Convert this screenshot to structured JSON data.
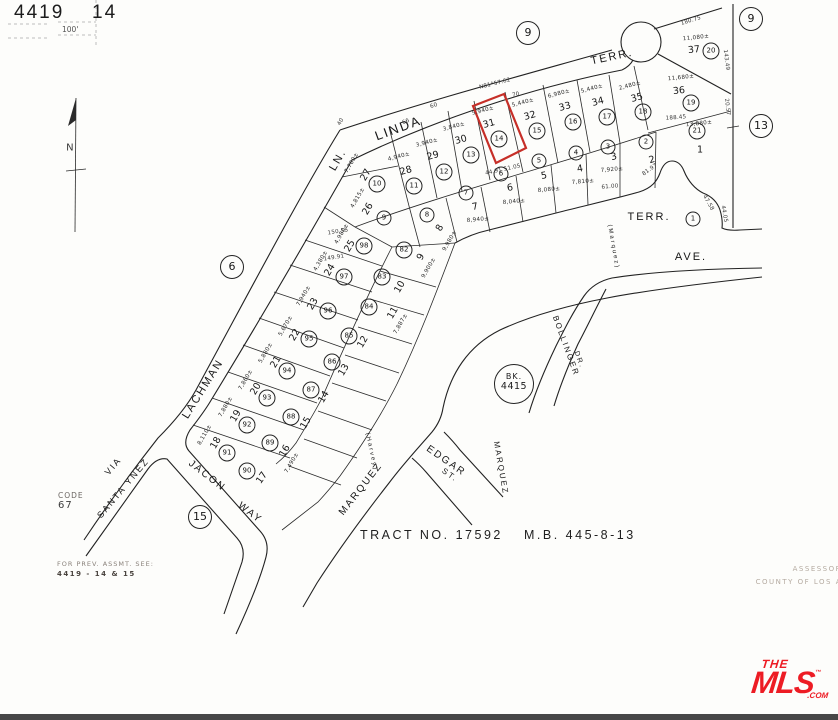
{
  "page": {
    "book": "4419",
    "sheet": "14",
    "scale": "100'"
  },
  "annotations": {
    "tract": "TRACT NO. 17592",
    "map_book": "M.B. 445-8-13",
    "code_label": "CODE",
    "code_value": "67",
    "prev_note_1": "FOR PREV. ASSMT. SEE:",
    "prev_note_2": "4419 - 14 & 15",
    "assessor_1": "ASSESSOR",
    "assessor_2": "COUNTY OF LOS A",
    "north_letter": "N"
  },
  "bk_badge": {
    "line1": "BK.",
    "line2": "4415"
  },
  "logo": {
    "the": "THE",
    "mls": "MLS",
    "tm": "™",
    "com": ".COM",
    "color": "#ed1c24"
  },
  "highlight": {
    "lot": "31",
    "color": "#c62f28"
  },
  "page_refs": [
    {
      "t": "9",
      "x": 528,
      "y": 33
    },
    {
      "t": "9",
      "x": 751,
      "y": 19
    },
    {
      "t": "13",
      "x": 761,
      "y": 126
    },
    {
      "t": "6",
      "x": 232,
      "y": 267
    },
    {
      "t": "15",
      "x": 200,
      "y": 517
    }
  ],
  "streets": [
    {
      "t": "LINDA",
      "x": 398,
      "y": 128,
      "r": -20,
      "s": 13
    },
    {
      "t": "LN.",
      "x": 338,
      "y": 160,
      "r": -60,
      "s": 11
    },
    {
      "t": "TERR.",
      "x": 612,
      "y": 57,
      "r": -12,
      "s": 11
    },
    {
      "t": "LACHMAN",
      "x": 203,
      "y": 389,
      "r": -58,
      "s": 11
    },
    {
      "t": "TERR.",
      "x": 649,
      "y": 217,
      "r": 0,
      "s": 11
    },
    {
      "t": "AVE.",
      "x": 691,
      "y": 257,
      "r": 0,
      "s": 11
    },
    {
      "t": "(Marquez)",
      "x": 613,
      "y": 247,
      "r": 80,
      "s": 6
    },
    {
      "t": "BOLLINGER",
      "x": 566,
      "y": 346,
      "r": 70,
      "s": 8
    },
    {
      "t": "DR.",
      "x": 579,
      "y": 360,
      "r": 70,
      "s": 7
    },
    {
      "t": "EDGAR",
      "x": 446,
      "y": 461,
      "r": 35,
      "s": 10
    },
    {
      "t": "ST.",
      "x": 450,
      "y": 475,
      "r": 35,
      "s": 8
    },
    {
      "t": "MARQUEZ",
      "x": 361,
      "y": 489,
      "r": -52,
      "s": 10
    },
    {
      "t": "MARQUEZ",
      "x": 501,
      "y": 468,
      "r": 80,
      "s": 8
    },
    {
      "t": "(Harvey)",
      "x": 371,
      "y": 452,
      "r": 78,
      "s": 6
    },
    {
      "t": "JACON",
      "x": 207,
      "y": 476,
      "r": 38,
      "s": 10
    },
    {
      "t": "WAY",
      "x": 250,
      "y": 513,
      "r": 38,
      "s": 10
    },
    {
      "t": "VIA",
      "x": 113,
      "y": 466,
      "r": -50,
      "s": 9
    },
    {
      "t": "SANTA YNEZ",
      "x": 123,
      "y": 488,
      "r": -50,
      "s": 9
    }
  ],
  "dims": [
    {
      "t": "N81°57.62",
      "x": 495,
      "y": 84,
      "r": -14
    },
    {
      "t": "70",
      "x": 516,
      "y": 95,
      "r": -14
    },
    {
      "t": "66",
      "x": 406,
      "y": 122,
      "r": -22
    },
    {
      "t": "60",
      "x": 434,
      "y": 106,
      "r": -20
    },
    {
      "t": "40",
      "x": 341,
      "y": 122,
      "r": -60
    },
    {
      "t": "44.91  51.05",
      "x": 503,
      "y": 170,
      "r": -12
    },
    {
      "t": "180.75",
      "x": 691,
      "y": 21,
      "r": -17
    },
    {
      "t": "143.49",
      "x": 726,
      "y": 60,
      "r": 83
    },
    {
      "t": "20.57",
      "x": 727,
      "y": 107,
      "r": 83
    },
    {
      "t": "188.45",
      "x": 676,
      "y": 118,
      "r": -4
    },
    {
      "t": "81.97",
      "x": 650,
      "y": 170,
      "r": -35
    },
    {
      "t": "61.00",
      "x": 610,
      "y": 187,
      "r": -5
    },
    {
      "t": "150.55",
      "x": 338,
      "y": 232,
      "r": -9
    },
    {
      "t": "149.91",
      "x": 334,
      "y": 258,
      "r": -9
    },
    {
      "t": "47.58",
      "x": 708,
      "y": 203,
      "r": 60
    },
    {
      "t": "44.05",
      "x": 724,
      "y": 214,
      "r": 80
    },
    {
      "t": "N",
      "x": 70,
      "y": 148,
      "r": 0,
      "s": 10
    }
  ],
  "lots": [
    {
      "n": "1",
      "x": 700,
      "y": 150,
      "r": 0,
      "c": "21",
      "cx": 697,
      "cy": 131,
      "a": "13,880±",
      "ax": 699,
      "ay": 124,
      "ar": -6
    },
    {
      "n": "2",
      "x": 652,
      "y": 160,
      "r": -15,
      "c": "2",
      "cx": 646,
      "cy": 142
    },
    {
      "n": "3",
      "x": 614,
      "y": 157,
      "r": -12,
      "c": "3",
      "cx": 608,
      "cy": 147,
      "a": "7,920±",
      "ax": 612,
      "ay": 170,
      "ar": -5
    },
    {
      "n": "4",
      "x": 580,
      "y": 169,
      "r": -10,
      "c": "4",
      "cx": 576,
      "cy": 153,
      "a": "7,810±",
      "ax": 583,
      "ay": 182,
      "ar": -5
    },
    {
      "n": "5",
      "x": 544,
      "y": 176,
      "r": -10,
      "c": "5",
      "cx": 539,
      "cy": 161,
      "a": "8,080±",
      "ax": 549,
      "ay": 190,
      "ar": -5
    },
    {
      "n": "6",
      "x": 510,
      "y": 188,
      "r": -10,
      "c": "6",
      "cx": 501,
      "cy": 174,
      "a": "8,040±",
      "ax": 514,
      "ay": 202,
      "ar": -5
    },
    {
      "n": "7",
      "x": 475,
      "y": 207,
      "r": -10,
      "c": "7",
      "cx": 466,
      "cy": 193,
      "a": "8,940±",
      "ax": 478,
      "ay": 220,
      "ar": -5
    },
    {
      "n": "8",
      "x": 440,
      "y": 228,
      "r": -60,
      "c": "8",
      "cx": 427,
      "cy": 215,
      "a": "9,980±",
      "ax": 450,
      "ay": 241,
      "ar": -60
    },
    {
      "n": "9",
      "x": 421,
      "y": 257,
      "r": -60,
      "c": "82",
      "cx": 404,
      "cy": 250,
      "a": "9,900±",
      "ax": 429,
      "ay": 268,
      "ar": -60
    },
    {
      "n": "10",
      "x": 400,
      "y": 287,
      "r": -60,
      "c": "83",
      "cx": 382,
      "cy": 277
    },
    {
      "n": "11",
      "x": 393,
      "y": 313,
      "r": -60,
      "c": "84",
      "cx": 369,
      "cy": 307,
      "a": "7,887±",
      "ax": 401,
      "ay": 324,
      "ar": -60
    },
    {
      "n": "12",
      "x": 363,
      "y": 342,
      "r": -60,
      "c": "85",
      "cx": 349,
      "cy": 336
    },
    {
      "n": "13",
      "x": 344,
      "y": 370,
      "r": -60,
      "c": "86",
      "cx": 332,
      "cy": 362
    },
    {
      "n": "14",
      "x": 324,
      "y": 397,
      "r": -60,
      "c": "87",
      "cx": 311,
      "cy": 390
    },
    {
      "n": "15",
      "x": 306,
      "y": 423,
      "r": -60,
      "c": "88",
      "cx": 291,
      "cy": 417
    },
    {
      "n": "16",
      "x": 285,
      "y": 451,
      "r": -60,
      "c": "89",
      "cx": 270,
      "cy": 443,
      "a": "7,490±",
      "ax": 292,
      "ay": 463,
      "ar": -60
    },
    {
      "n": "17",
      "x": 262,
      "y": 478,
      "r": -55,
      "c": "90",
      "cx": 247,
      "cy": 471
    },
    {
      "n": "18",
      "x": 216,
      "y": 443,
      "r": -60,
      "c": "91",
      "cx": 227,
      "cy": 453,
      "a": "8,110±",
      "ax": 205,
      "ay": 435,
      "ar": -60
    },
    {
      "n": "19",
      "x": 236,
      "y": 416,
      "r": -60,
      "c": "92",
      "cx": 247,
      "cy": 425,
      "a": "7,880±",
      "ax": 226,
      "ay": 407,
      "ar": -60
    },
    {
      "n": "20",
      "x": 256,
      "y": 389,
      "r": -60,
      "c": "93",
      "cx": 267,
      "cy": 398,
      "a": "7,860±",
      "ax": 246,
      "ay": 380,
      "ar": -60
    },
    {
      "n": "21",
      "x": 276,
      "y": 362,
      "r": -60,
      "c": "94",
      "cx": 287,
      "cy": 371,
      "a": "5,880±",
      "ax": 266,
      "ay": 353,
      "ar": -60
    },
    {
      "n": "22",
      "x": 295,
      "y": 335,
      "r": -60,
      "c": "95",
      "cx": 309,
      "cy": 339,
      "a": "5,670±",
      "ax": 286,
      "ay": 326,
      "ar": -60
    },
    {
      "n": "23",
      "x": 313,
      "y": 304,
      "r": -60,
      "c": "96",
      "cx": 328,
      "cy": 311,
      "a": "7,940±",
      "ax": 304,
      "ay": 296,
      "ar": -60
    },
    {
      "n": "24",
      "x": 330,
      "y": 270,
      "r": -60,
      "c": "97",
      "cx": 344,
      "cy": 277,
      "a": "4,380±",
      "ax": 321,
      "ay": 261,
      "ar": -60
    },
    {
      "n": "25",
      "x": 350,
      "y": 246,
      "r": -60,
      "c": "98",
      "cx": 364,
      "cy": 246,
      "a": "4,980±",
      "ax": 342,
      "ay": 234,
      "ar": -60
    },
    {
      "n": "26",
      "x": 368,
      "y": 209,
      "r": -60,
      "c": "9",
      "cx": 384,
      "cy": 218,
      "a": "4,815±",
      "ax": 358,
      "ay": 198,
      "ar": -60
    },
    {
      "n": "27",
      "x": 366,
      "y": 175,
      "r": -60,
      "c": "10",
      "cx": 377,
      "cy": 184,
      "a": "7,780±",
      "ax": 352,
      "ay": 163,
      "ar": -60
    },
    {
      "n": "28",
      "x": 406,
      "y": 171,
      "r": -15,
      "c": "11",
      "cx": 414,
      "cy": 186,
      "a": "4,940±",
      "ax": 399,
      "ay": 157,
      "ar": -15
    },
    {
      "n": "29",
      "x": 433,
      "y": 156,
      "r": -15,
      "c": "12",
      "cx": 444,
      "cy": 172,
      "a": "3,940±",
      "ax": 427,
      "ay": 143,
      "ar": -15
    },
    {
      "n": "30",
      "x": 461,
      "y": 140,
      "r": -15,
      "c": "13",
      "cx": 471,
      "cy": 155,
      "a": "3,840±",
      "ax": 454,
      "ay": 127,
      "ar": -15
    },
    {
      "n": "31",
      "x": 489,
      "y": 124,
      "r": -15,
      "c": "14",
      "cx": 499,
      "cy": 139,
      "a": "5,940±",
      "ax": 483,
      "ay": 111,
      "ar": -15
    },
    {
      "n": "32",
      "x": 530,
      "y": 116,
      "r": -15,
      "c": "15",
      "cx": 537,
      "cy": 131,
      "a": "5,440±",
      "ax": 523,
      "ay": 103,
      "ar": -15
    },
    {
      "n": "33",
      "x": 565,
      "y": 107,
      "r": -15,
      "c": "16",
      "cx": 573,
      "cy": 122,
      "a": "6,980±",
      "ax": 559,
      "ay": 94,
      "ar": -15
    },
    {
      "n": "34",
      "x": 598,
      "y": 102,
      "r": -15,
      "c": "17",
      "cx": 607,
      "cy": 117,
      "a": "5,440±",
      "ax": 592,
      "ay": 89,
      "ar": -15
    },
    {
      "n": "35",
      "x": 637,
      "y": 98,
      "r": -15,
      "c": "18",
      "cx": 643,
      "cy": 112,
      "a": "2,480±",
      "ax": 630,
      "ay": 86,
      "ar": -15
    },
    {
      "n": "36",
      "x": 679,
      "y": 91,
      "r": -6,
      "c": "19",
      "cx": 691,
      "cy": 103,
      "a": "11,680±",
      "ax": 681,
      "ay": 78,
      "ar": -6
    },
    {
      "n": "37",
      "x": 694,
      "y": 50,
      "r": -6,
      "c": "20",
      "cx": 711,
      "cy": 51,
      "a": "11,080±",
      "ax": 696,
      "ay": 38,
      "ar": -6
    },
    {
      "c": "1",
      "cx": 693,
      "cy": 219
    }
  ]
}
